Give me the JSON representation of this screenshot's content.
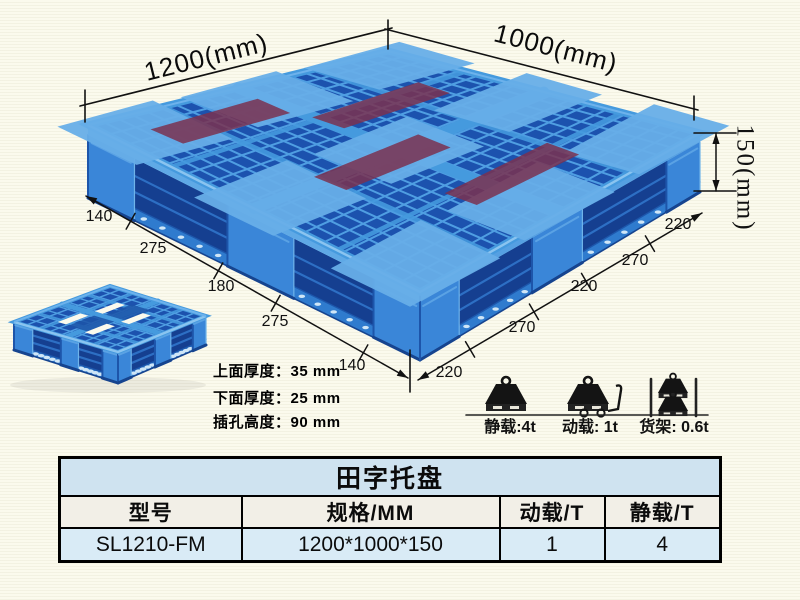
{
  "diagram": {
    "length_label": "1200(mm)",
    "width_label": "1000(mm)",
    "height_label": "150(mm)",
    "left_segments": [
      "140",
      "275",
      "180",
      "275",
      "140"
    ],
    "right_segments": [
      "220",
      "270",
      "220",
      "270",
      "220"
    ],
    "notes": [
      "上面厚度：35 mm",
      "下面厚度：25 mm",
      "插孔高度：90 mm"
    ],
    "load_ratings": [
      {
        "icon": "static-load-icon",
        "label": "静载:4t"
      },
      {
        "icon": "dynamic-load-icon",
        "label": "动载: 1t"
      },
      {
        "icon": "rack-load-icon",
        "label": "货架: 0.6t"
      }
    ]
  },
  "table": {
    "title": "田字托盘",
    "headers": [
      "型号",
      "规格/MM",
      "动载/T",
      "静载/T"
    ],
    "rows": [
      [
        "SL1210-FM",
        "1200*1000*150",
        "1",
        "4"
      ]
    ]
  },
  "colors": {
    "pallet_blue": "#2e7fd2",
    "pallet_dark": "#1c52ae",
    "pallet_light": "#5aa7e6",
    "table_title_bg": "#cfe3f0",
    "table_header_bg": "#f2efe7",
    "table_data_bg": "#d9ebf6",
    "background": "#fbfaed"
  }
}
